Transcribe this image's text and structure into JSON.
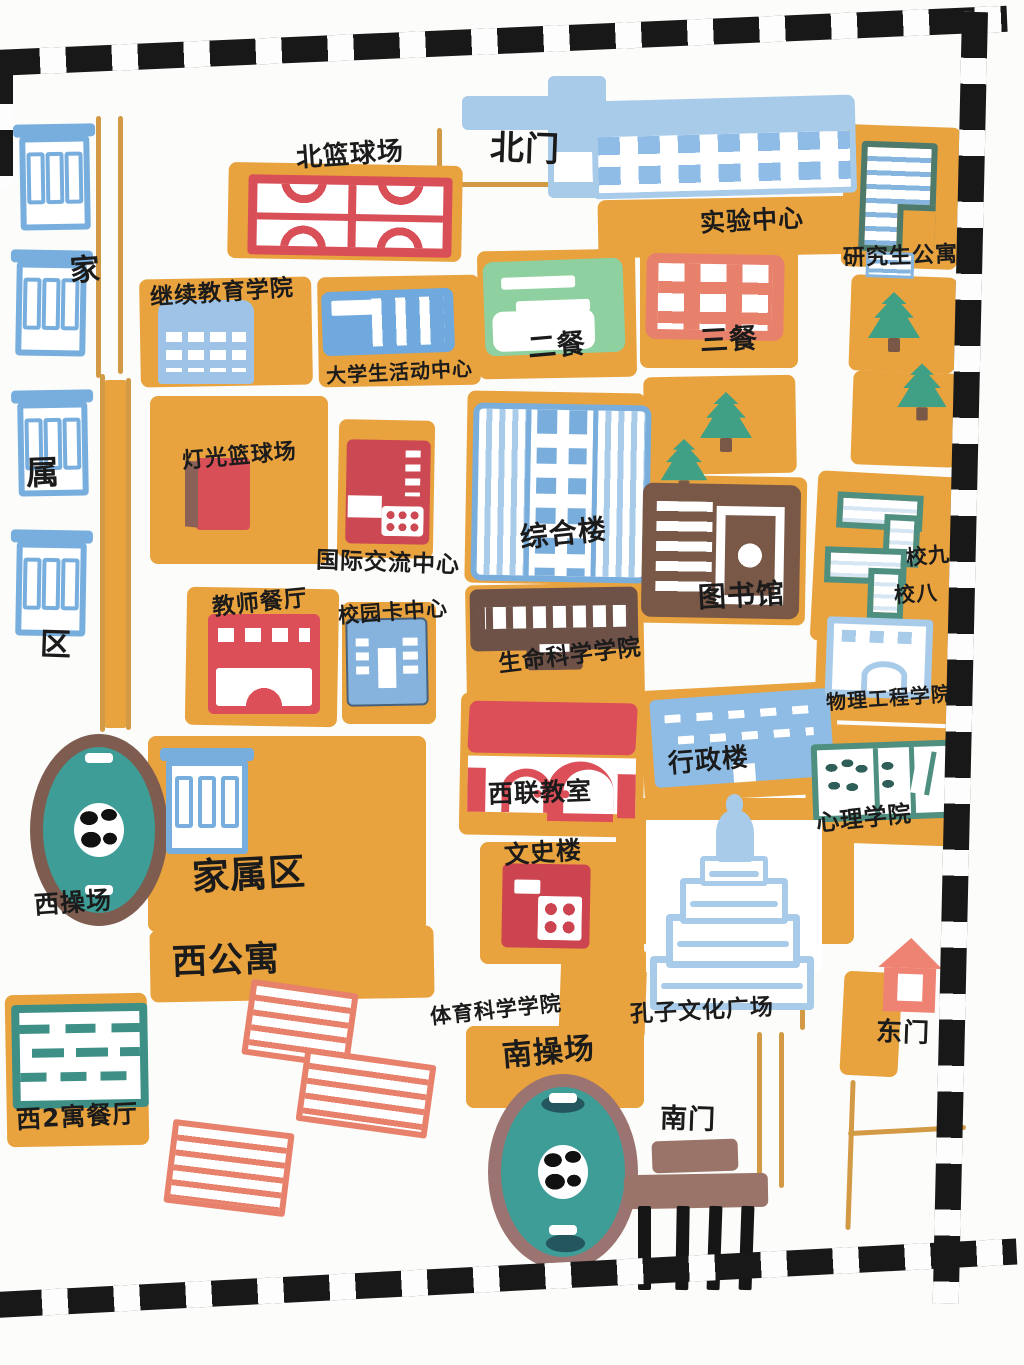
{
  "map": {
    "title": "hand-drawn campus map",
    "colors": {
      "block_orange": "#E8A23E",
      "court_red": "#D94F58",
      "salmon": "#E8816B",
      "building_blue": "#77AEDE",
      "pale_blue": "#A8CBEA",
      "dining_green": "#8FD0A0",
      "tree_green": "#3FA085",
      "field_teal": "#3E9D97",
      "ring_brown": "#7E5C50",
      "ring_mauve": "#9B7370",
      "library_brown": "#7A5847",
      "gate_mauve": "#9A7468",
      "teal_outline": "#3E8F86",
      "border_black": "#181818",
      "ink": "#1b1b1b"
    },
    "labels": {
      "north_basketball_court": "北篮球场",
      "north_gate": "北门",
      "experiment_center": "实验中心",
      "graduate_apartments": "研究生公寓",
      "continuing_education": "继续教育学院",
      "student_activity_center": "大学生活动中心",
      "dining_hall_2": "二餐",
      "dining_hall_3": "三餐",
      "floodlit_basketball_court": "灯光篮球场",
      "international_exchange_center": "国际交流中心",
      "teachers_dining_hall": "教师餐厅",
      "campus_card_center": "校园卡中心",
      "comprehensive_building": "综合楼",
      "library": "图书馆",
      "life_science_college": "生命科学学院",
      "administration_building": "行政楼",
      "west_union_classroom": "西联教室",
      "wenshi_building": "文史楼",
      "sports_science_college": "体育科学学院",
      "confucius_culture_square": "孔子文化广场",
      "south_playground": "南操场",
      "south_gate": "南门",
      "east_gate": "东门",
      "west_playground": "西操场",
      "family_area": "家属区",
      "west_apartments": "西公寓",
      "west2_apartment_dining": "西2寓餐厅",
      "dorm_9": "校九",
      "dorm_8": "校八",
      "physics_engineering_college": "物理工程学院",
      "psychology_college": "心理学院",
      "family_vertical": [
        "家",
        "属",
        "区"
      ]
    }
  }
}
